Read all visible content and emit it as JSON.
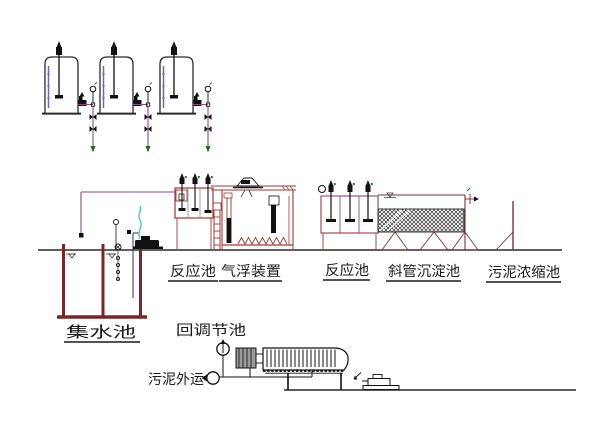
{
  "meta": {
    "drawing_type": "process-flow-elevation-diagram",
    "subject": "wastewater treatment plant profile",
    "language": "zh-CN"
  },
  "labels": {
    "collection_tank": "集水池",
    "reaction_tank_1": "反应池",
    "air_flotation_unit": "气浮装置",
    "reaction_tank_2": "反应池",
    "inclined_tube_settler": "斜管沉淀池",
    "sludge_thickener": "污泥浓缩池",
    "back_to_regulating_tank": "回调节池",
    "sludge_haul_away": "污泥外运"
  },
  "equipment_icons": [
    "dosing-tank-with-agitator",
    "dosing-pump",
    "pressure-gauge",
    "shutoff-valve",
    "collection-tank",
    "float-level-switch",
    "transfer-pump",
    "reaction-tank-mixers",
    "access-ladder",
    "air-flotation-skimmer",
    "aerator-diffusers",
    "inclined-tube-media",
    "support-trestle",
    "outlet-weir",
    "plate-frame-filter-press",
    "filter-press-feed-motor",
    "screw-pump",
    "flow-circle-symbol"
  ],
  "colors": {
    "background": "#ffffff",
    "linework_black": "#1a1a1a",
    "tank_wall_red": "#7a2626",
    "equipment_red": "#a03a33",
    "pipe_magenta": "#8a4a8a",
    "level_gauge_blue": "#6a6ab0",
    "hose_cyan": "#5ac8c8",
    "marker_green": "#2a7a2a",
    "hatch_dark": "#2f2f2f"
  }
}
